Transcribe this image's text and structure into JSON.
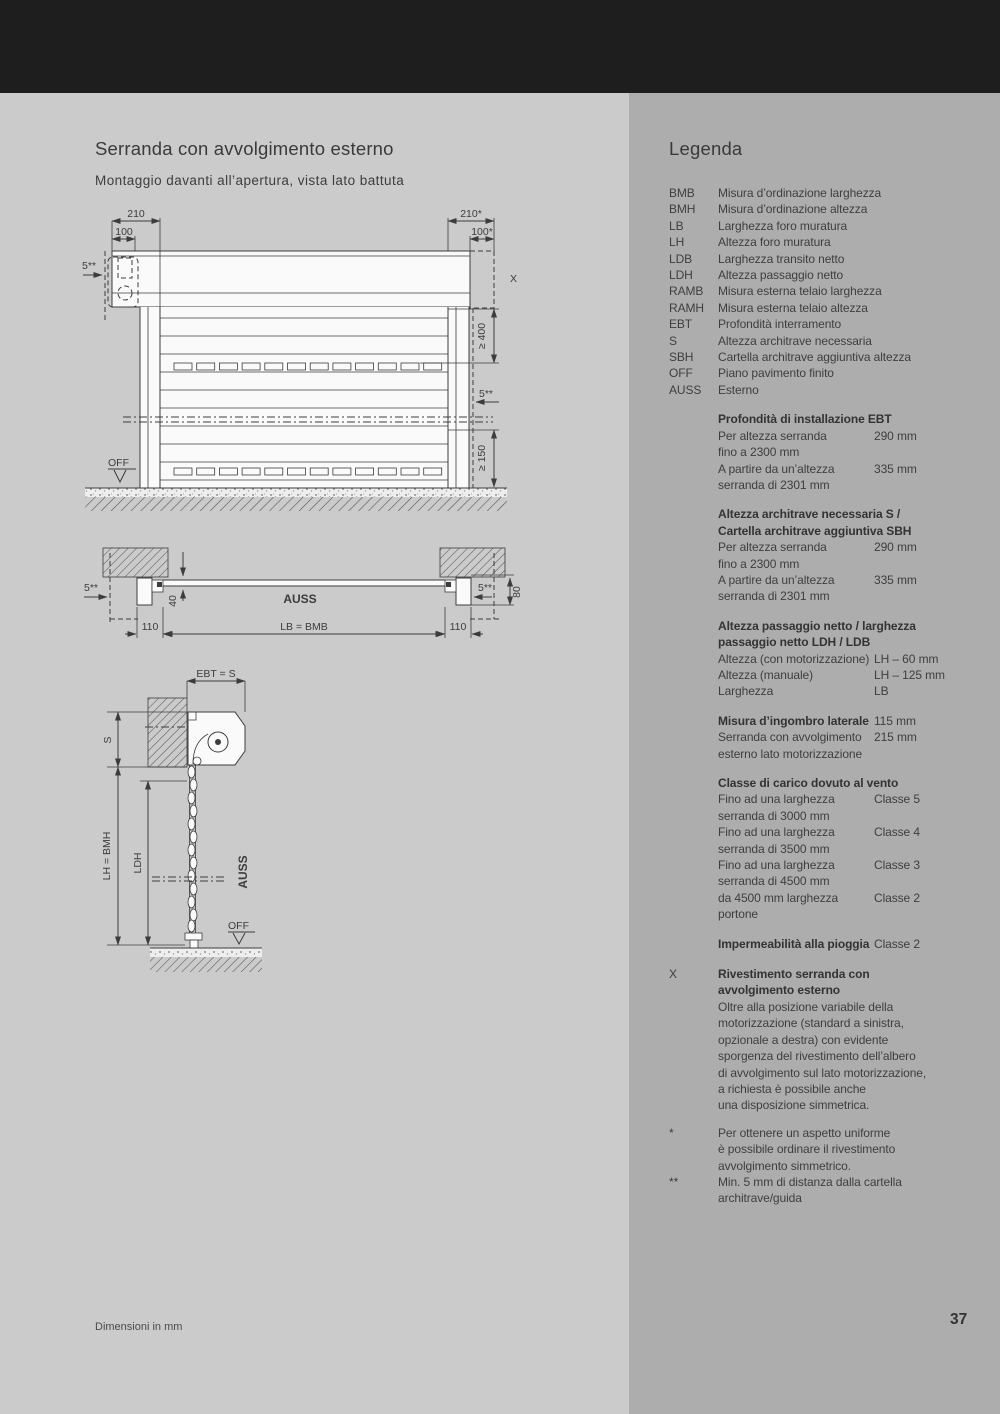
{
  "page": {
    "footer": "Dimensioni in mm",
    "number": "37",
    "colors": {
      "top_band": "#1e1e1e",
      "bg_left": "#cbcbcb",
      "bg_right": "#adadad",
      "text": "#3c3c3c"
    }
  },
  "left": {
    "title": "Serranda con avvolgimento esterno",
    "subtitle": "Montaggio davanti all’apertura, vista lato battuta",
    "d1": {
      "w210": "210",
      "w100": "100",
      "off5l": "5**",
      "w210r": "210*",
      "w100r": "100*",
      "x": "X",
      "g400": "≥ 400",
      "off5r": "5**",
      "g150": "≥ 150",
      "off": "OFF"
    },
    "d2": {
      "off5l": "5**",
      "d40": "40",
      "auss": "AUSS",
      "lb": "LB = BMB",
      "d110l": "110",
      "d110r": "110",
      "off5r": "5**",
      "d80": "80"
    },
    "d3": {
      "ebt": "EBT = S",
      "s": "S",
      "lh": "LH = BMH",
      "ldh": "LDH",
      "auss": "AUSS",
      "off": "OFF"
    }
  },
  "legend": {
    "heading": "Legenda",
    "lines": [
      {
        "m": "BMB",
        "t": "Misura d’ordinazione larghezza"
      },
      {
        "m": "BMH",
        "t": "Misura d’ordinazione altezza"
      },
      {
        "m": "LB",
        "t": "Larghezza foro muratura"
      },
      {
        "m": "LH",
        "t": "Altezza foro muratura"
      },
      {
        "m": "LDB",
        "t": "Larghezza transito netto"
      },
      {
        "m": "LDH",
        "t": "Altezza passaggio netto"
      },
      {
        "m": "RAMB",
        "t": "Misura esterna telaio larghezza"
      },
      {
        "m": "RAMH",
        "t": "Misura esterna telaio altezza"
      },
      {
        "m": "EBT",
        "t": "Profondità interramento"
      },
      {
        "m": "S",
        "t": "Altezza architrave necessaria"
      },
      {
        "m": "SBH",
        "t": "Cartella architrave aggiuntiva altezza"
      },
      {
        "m": "OFF",
        "t": "Piano pavimento finito"
      },
      {
        "m": "AUSS",
        "t": "Esterno"
      },
      {
        "t": "Profondità di installazione EBT",
        "b": 1,
        "mt": 13
      },
      {
        "t": "Per altezza serranda",
        "v": "290 mm"
      },
      {
        "t": "fino a 2300 mm"
      },
      {
        "t": "A partire da un’altezza",
        "v": "335 mm"
      },
      {
        "t": "serranda di 2301 mm"
      },
      {
        "t": "Altezza architrave necessaria S /",
        "b": 1,
        "mt": 13
      },
      {
        "t": "Cartella architrave aggiuntiva SBH",
        "b": 1
      },
      {
        "t": "Per altezza serranda",
        "v": "290 mm"
      },
      {
        "t": "fino a 2300 mm"
      },
      {
        "t": "A partire da un’altezza",
        "v": "335 mm"
      },
      {
        "t": "serranda di 2301 mm"
      },
      {
        "t": "Altezza passaggio netto / larghezza",
        "b": 1,
        "mt": 13
      },
      {
        "t": "passaggio netto LDH / LDB",
        "b": 1
      },
      {
        "t": "Altezza (con motorizzazione)",
        "v": "LH – 60 mm"
      },
      {
        "t": "Altezza (manuale)",
        "v": "LH – 125 mm"
      },
      {
        "t": "Larghezza",
        "v": "LB"
      },
      {
        "t": "Misura d’ingombro laterale",
        "v": "115 mm",
        "b": 1,
        "mt": 13
      },
      {
        "t": "Serranda con avvolgimento",
        "v": "215 mm"
      },
      {
        "t": "esterno lato motorizzazione"
      },
      {
        "t": "Classe di carico dovuto al vento",
        "b": 1,
        "mt": 13
      },
      {
        "t": "Fino ad una larghezza",
        "v": "Classe 5"
      },
      {
        "t": "serranda di 3000 mm"
      },
      {
        "t": "Fino ad una larghezza",
        "v": "Classe 4"
      },
      {
        "t": "serranda di 3500 mm"
      },
      {
        "t": "Fino ad una larghezza",
        "v": "Classe 3"
      },
      {
        "t": "serranda di 4500 mm"
      },
      {
        "t": "da 4500 mm larghezza",
        "v": "Classe 2"
      },
      {
        "t": "portone"
      },
      {
        "t": "Impermeabilità alla pioggia",
        "v": "Classe 2",
        "b": 1,
        "mt": 13
      },
      {
        "m": "X",
        "t": "Rivestimento serranda con",
        "b": 1,
        "mt": 14
      },
      {
        "t": "avvolgimento esterno",
        "b": 1
      },
      {
        "t": "Oltre alla posizione variabile della"
      },
      {
        "t": "motorizzazione (standard a sinistra,"
      },
      {
        "t": "opzionale a destra) con evidente"
      },
      {
        "t": "sporgenza del rivestimento dell’albero"
      },
      {
        "t": "di avvolgimento sul lato motorizzazione,"
      },
      {
        "t": "a richiesta è possibile anche"
      },
      {
        "t": "una disposizione simmetrica."
      },
      {
        "m": "*",
        "t": "Per ottenere un aspetto uniforme",
        "mt": 11
      },
      {
        "t": "è possibile ordinare il rivestimento"
      },
      {
        "t": "avvolgimento simmetrico."
      },
      {
        "m": "**",
        "t": "Min. 5 mm di distanza dalla cartella"
      },
      {
        "t": "architrave/guida"
      }
    ]
  }
}
